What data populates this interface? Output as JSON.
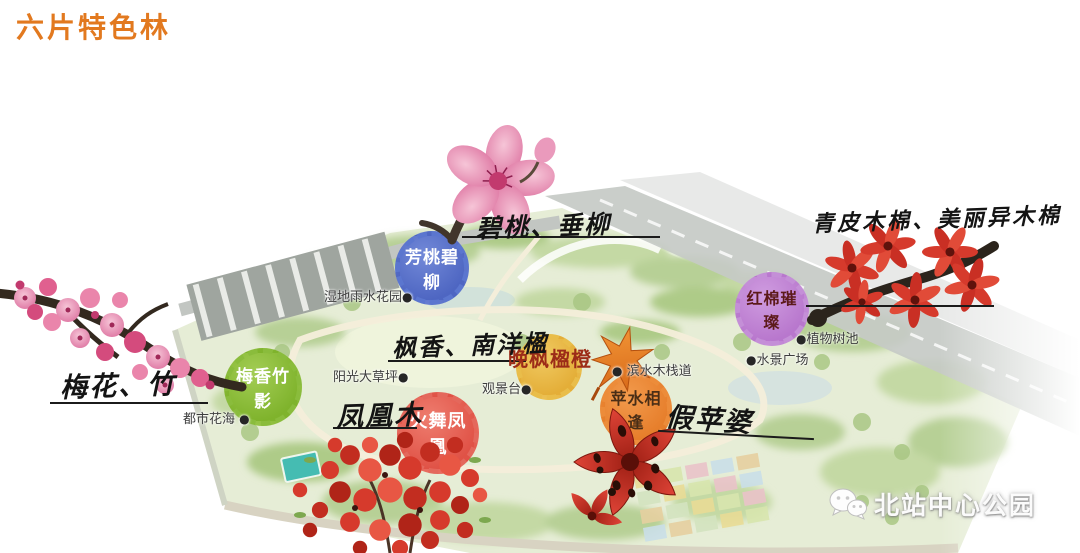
{
  "title": "六片特色林",
  "zones": [
    {
      "name": "芳桃碧柳",
      "species": "碧桃、垂柳",
      "color": "#5b76cf",
      "text_color": "#ffffff"
    },
    {
      "name": "梅香竹影",
      "species": "梅花、竹",
      "color": "#8abc3c",
      "text_color": "#ffffff"
    },
    {
      "name": "火舞凤凰",
      "species": "凤凰木",
      "color": "#e4685c",
      "text_color": "#ffffff"
    },
    {
      "name": "晚枫楹橙",
      "species": "枫香、南洋楹",
      "color": "#e9bd4a",
      "text_color": "#9c2c18"
    },
    {
      "name": "苹水相逢",
      "species": "假苹婆",
      "color": "#ec8c3a",
      "text_color": "#4a2e16"
    },
    {
      "name": "红棉璀璨",
      "species": "青皮木棉、美丽异木棉",
      "color": "#c48fd7",
      "text_color": "#5c1a1a"
    }
  ],
  "map_labels": [
    {
      "text": "湿地雨水花园"
    },
    {
      "text": "阳光大草坪"
    },
    {
      "text": "观景台"
    },
    {
      "text": "都市花海"
    },
    {
      "text": "滨水木栈道"
    },
    {
      "text": "水景广场"
    },
    {
      "text": "植物树池"
    }
  ],
  "watermark": {
    "text": "北站中心公园",
    "icon": "wechat-icon"
  },
  "photos": [
    {
      "icon": "peach-blossom-photo"
    },
    {
      "icon": "plum-blossom-branch-photo"
    },
    {
      "icon": "kapok-flower-branch-photo"
    },
    {
      "icon": "flame-tree-flowers-photo"
    },
    {
      "icon": "sterculia-flower-photo"
    },
    {
      "icon": "maple-leaf-marker"
    }
  ],
  "accent_colors": {
    "title_orange": "#e2791f",
    "park_green": "#e6edd6",
    "road_gray": "#c6cac6"
  }
}
